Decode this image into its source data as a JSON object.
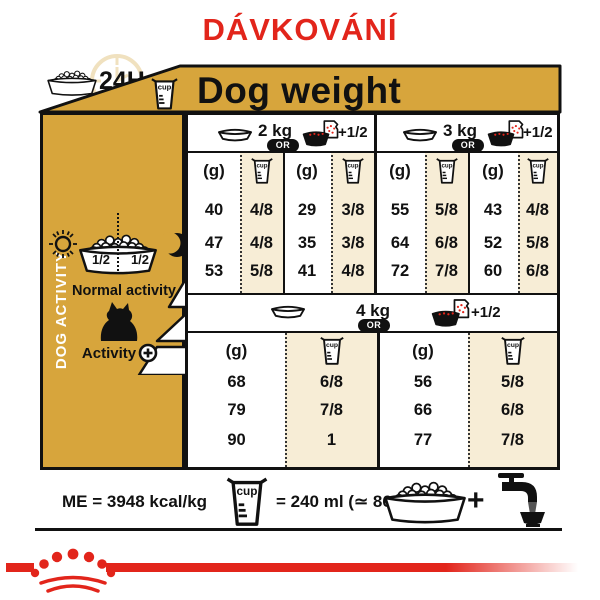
{
  "title": "DÁVKOVÁNÍ",
  "top": {
    "daily_label": "24H"
  },
  "table": {
    "header": "Dog weight",
    "cup_text": "cup",
    "grams_label": "(g)",
    "or_label": "OR",
    "plus_half_label": "+1/2",
    "sections": [
      {
        "weight": "2 kg",
        "dry": {
          "g": [
            "40",
            "47",
            "53"
          ],
          "cup": [
            "4/8",
            "4/8",
            "5/8"
          ]
        },
        "mixed": {
          "g": [
            "29",
            "35",
            "41"
          ],
          "cup": [
            "3/8",
            "3/8",
            "4/8"
          ]
        }
      },
      {
        "weight": "3 kg",
        "dry": {
          "g": [
            "55",
            "64",
            "72"
          ],
          "cup": [
            "5/8",
            "6/8",
            "7/8"
          ]
        },
        "mixed": {
          "g": [
            "43",
            "52",
            "60"
          ],
          "cup": [
            "4/8",
            "5/8",
            "6/8"
          ]
        }
      },
      {
        "weight": "4 kg",
        "dry": {
          "g": [
            "68",
            "79",
            "90"
          ],
          "cup": [
            "6/8",
            "7/8",
            "1"
          ]
        },
        "mixed": {
          "g": [
            "56",
            "66",
            "77"
          ],
          "cup": [
            "5/8",
            "6/8",
            "7/8"
          ]
        }
      }
    ]
  },
  "sidebar": {
    "vertical_label": "DOG ACTIVITY",
    "half_left": "1/2",
    "half_right": "1/2",
    "normal_activity": "Normal activity",
    "activity": "Activity",
    "activity_plus": "+"
  },
  "footer": {
    "me": "ME = 3948 kcal/kg",
    "cup_equals": "= 240 ml (≃ 86 g)",
    "plus": "+"
  },
  "colors": {
    "gold": "#D7A53C",
    "cream": "#F7EDD6",
    "red": "#E2251B",
    "black": "#111111"
  }
}
